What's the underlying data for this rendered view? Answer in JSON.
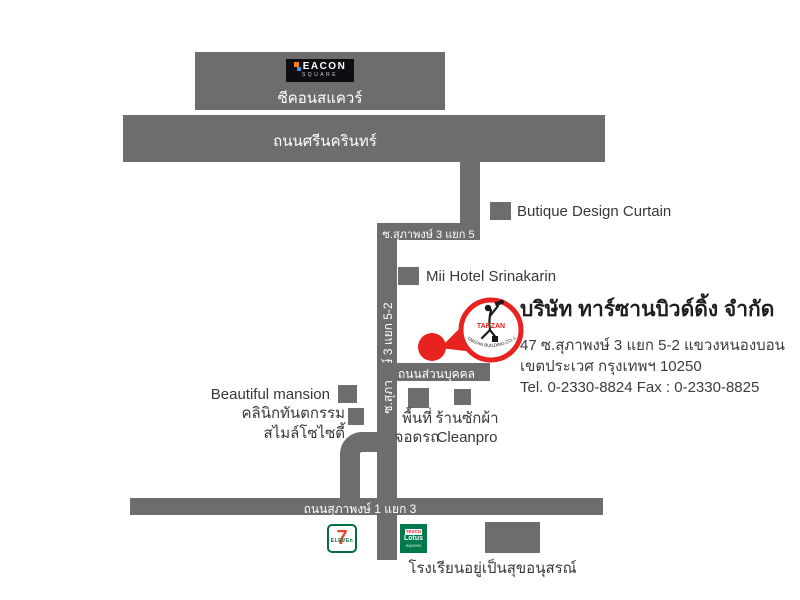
{
  "map": {
    "seacon": {
      "logo_line1": "EACON",
      "logo_line2": "SQUARE",
      "label": "ซีคอนสแควร์"
    },
    "roads": {
      "srinakarin": "ถนนศรีนครินทร์",
      "soi_5": "ซ.สุภาพงษ์ 3 แยก 5",
      "soi_5_2": "ซ.สุภาพงษ์ 3 แยก 5-2",
      "private_road": "ถนนส่วนบุคคล",
      "soi_1": "ถนนสุภาพงษ์ 1 แยก 3"
    },
    "places": {
      "butique": "Butique Design Curtain",
      "mii_hotel": "Mii Hotel Srinakarin",
      "beautiful_mansion": "Beautiful mansion",
      "clinic_line1": "คลินิกทันตกรรม",
      "clinic_line2": "สไมล์โซไซตี้",
      "parking_line1": "พื้นที่",
      "parking_line2": "จอดรถ",
      "laundry_line1": "ร้านซักผ้า",
      "laundry_line2": "Cleanpro",
      "school": "โรงเรียนอยู่เป็นสุขอนุสรณ์"
    },
    "logos": {
      "seven_eleven_number": "7",
      "seven_eleven_text": "ELEVEn",
      "tesco_line1": "TESCO",
      "tesco_line2": "Lotus",
      "tesco_line3": "express"
    }
  },
  "company": {
    "name": "บริษัท ทาร์ซานบิวด์ดิ้ง จำกัด",
    "address_line1": "47 ซ.สุภาพงษ์ 3 แยก 5-2 แขวงหนองบอน",
    "address_line2": "เขตประเวศ กรุงเทพฯ 10250",
    "contact": "Tel. 0-2330-8824 Fax : 0-2330-8825",
    "logo_text": "TARZAN",
    "logo_subtext": "TARZAN BUILDING CO.,LTD."
  },
  "colors": {
    "road_gray": "#6d6d6d",
    "accent_red": "#e8231f",
    "seven_green": "#00703c",
    "seven_orange": "#e8452c",
    "tesco_green": "#007a4d",
    "text_dark": "#383838"
  }
}
